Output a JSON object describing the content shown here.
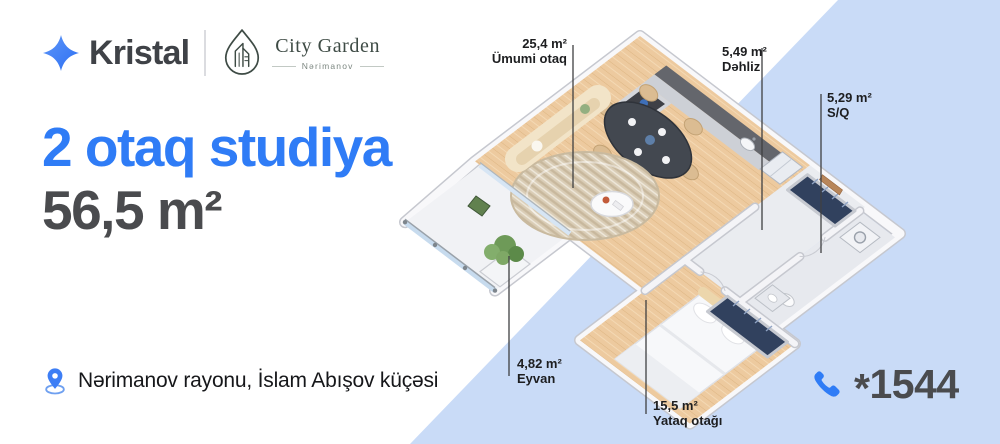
{
  "header": {
    "brand": "Kristal",
    "project_name": "City Garden",
    "project_subtitle": "Nərimanov"
  },
  "hero": {
    "title": "2 otaq studiya",
    "area": "56,5 m²"
  },
  "location": {
    "text": "Nərimanov rayonu, İslam Abışov küçəsi"
  },
  "phone": {
    "number": "1544",
    "prefix": "*"
  },
  "floorplan": {
    "rooms": [
      {
        "area": "25,4 m²",
        "name": "Ümumi otaq"
      },
      {
        "area": "5,49 m²",
        "name": "Dəhliz"
      },
      {
        "area": "5,29 m²",
        "name": "S/Q"
      },
      {
        "area": "4,82 m²",
        "name": "Eyvan"
      },
      {
        "area": "15,5 m²",
        "name": "Yataq otağı"
      }
    ]
  },
  "colors": {
    "accent_blue": "#2F7CF6",
    "panel_blue": "#C9DBF7",
    "text_dark": "#4A4B4E",
    "wood_floor": "#EDCA9F",
    "logo_green": "#3E4B45"
  }
}
